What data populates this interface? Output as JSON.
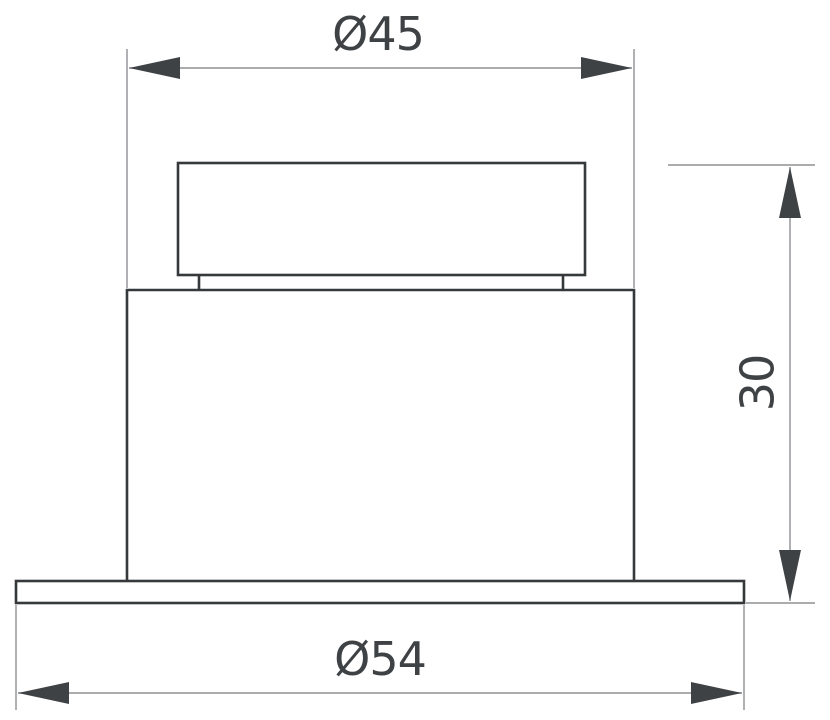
{
  "drawing": {
    "type": "technical-dimension-drawing",
    "subject": "recessed-downlight-side-profile",
    "dimensions": {
      "top_diameter_label": "Ø45",
      "cutout_height_label": "30",
      "flange_diameter_label": "Ø54"
    },
    "colors": {
      "background": "#ffffff",
      "outline": "#36393c",
      "dimension_line": "#8e9093",
      "arrow": "#3f4245",
      "text": "#3f4245"
    }
  }
}
